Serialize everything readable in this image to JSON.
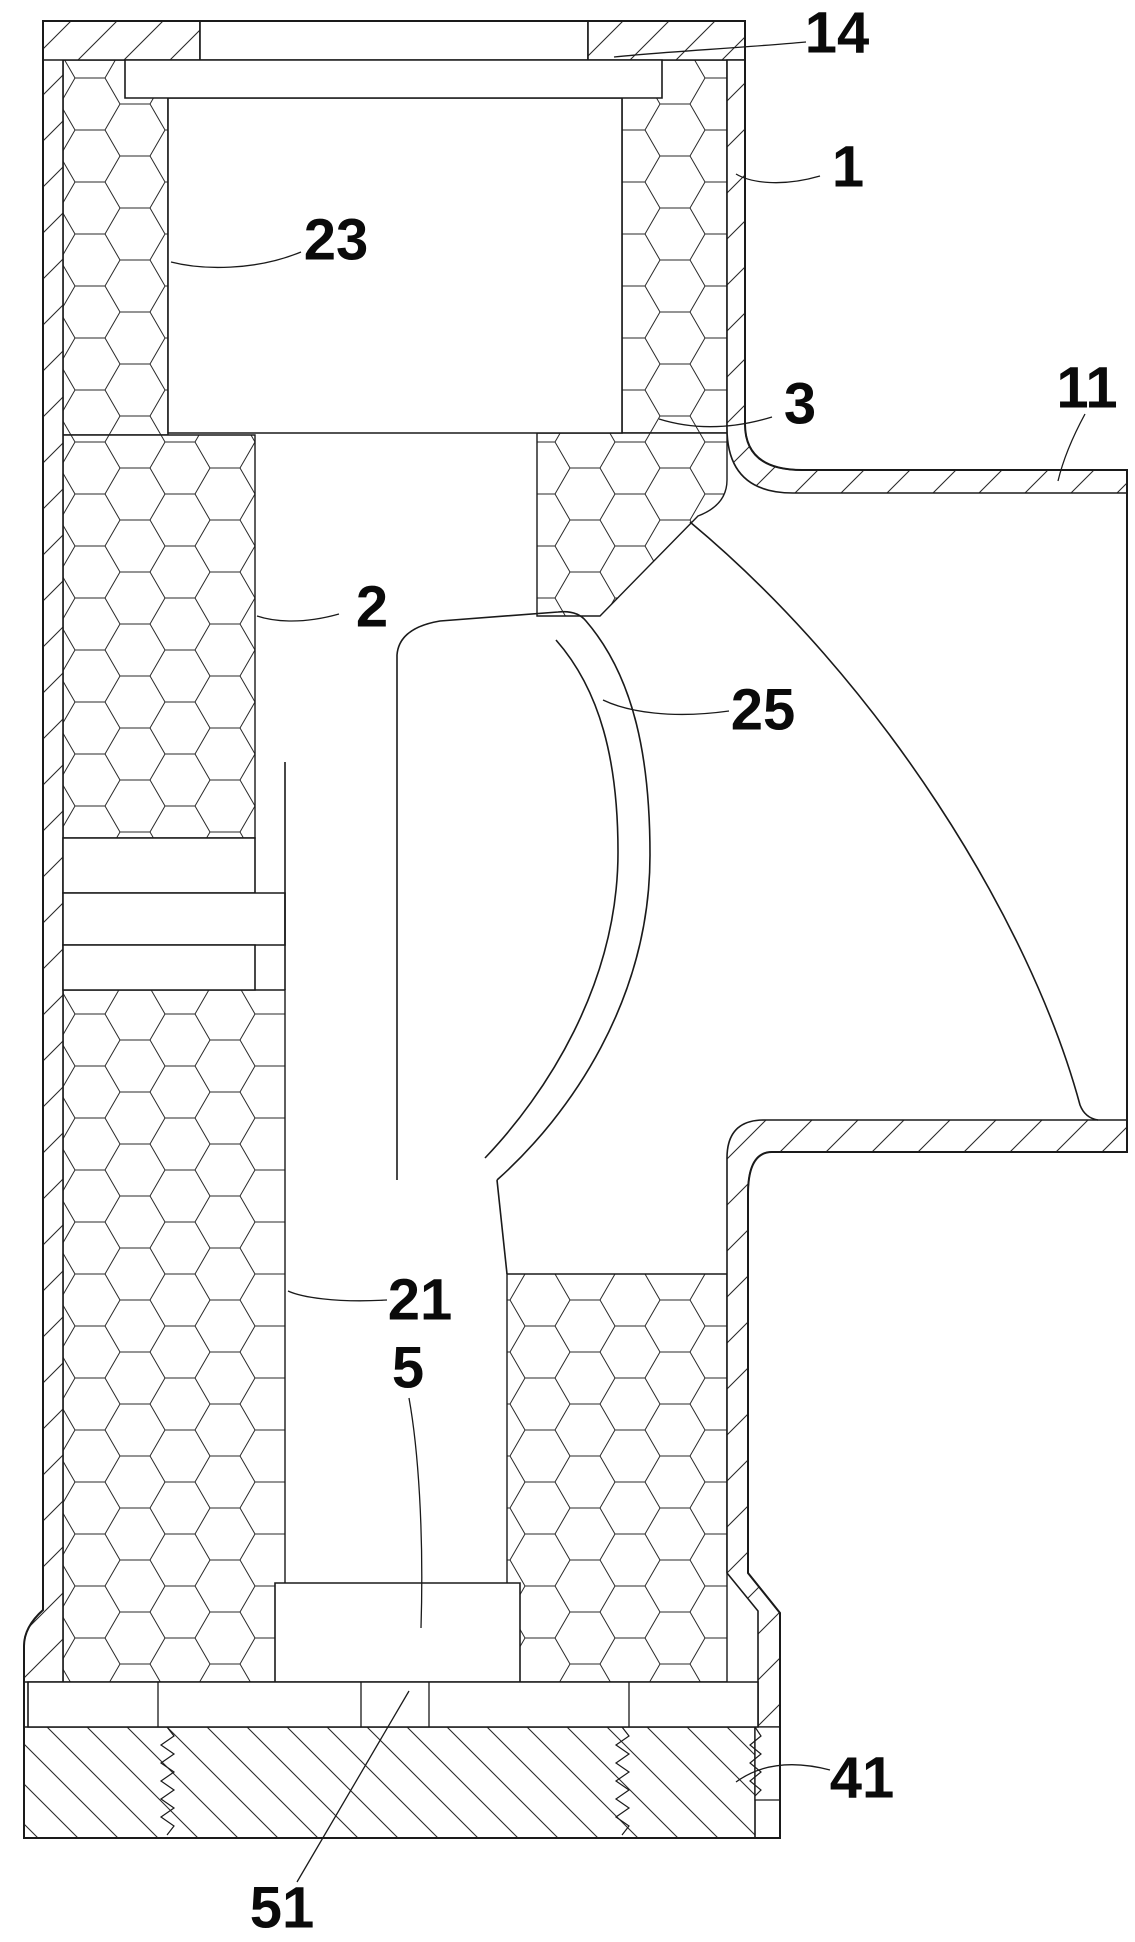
{
  "figure": {
    "kind": "patent-cross-section-drawing",
    "background_color": "#ffffff",
    "line_color": "#1a1a1a",
    "label_color": "#0a0a0a",
    "labels": [
      {
        "text": "14",
        "x": 837,
        "y": 33,
        "leader": "M806,42 C740,48 660,52 614,57"
      },
      {
        "text": "1",
        "x": 848,
        "y": 167,
        "leader": "M820,176 C782,187 751,183 736,174"
      },
      {
        "text": "23",
        "x": 336,
        "y": 240,
        "leader": "M301,252 C255,271 202,270 171,262"
      },
      {
        "text": "3",
        "x": 800,
        "y": 404,
        "leader": "M772,417 C726,431 688,428 659,419"
      },
      {
        "text": "11",
        "x": 1087,
        "y": 388,
        "leader": "M1085,414 C1072,438 1063,460 1058,481"
      },
      {
        "text": "2",
        "x": 372,
        "y": 607,
        "leader": "M339,614 C300,625 272,621 257,616"
      },
      {
        "text": "25",
        "x": 763,
        "y": 710,
        "leader": "M729,711 C672,719 628,712 603,700"
      },
      {
        "text": "21",
        "x": 420,
        "y": 1300,
        "leader": "M387,1300 C335,1303 301,1297 288,1291"
      },
      {
        "text": "5",
        "x": 408,
        "y": 1368,
        "leader": "M409,1398 C418,1448 424,1530 421,1628"
      },
      {
        "text": "41",
        "x": 862,
        "y": 1778,
        "leader": "M830,1770 C788,1759 758,1766 736,1782"
      },
      {
        "text": "51",
        "x": 282,
        "y": 1908,
        "leader": "M297,1882 L409,1691"
      }
    ]
  }
}
